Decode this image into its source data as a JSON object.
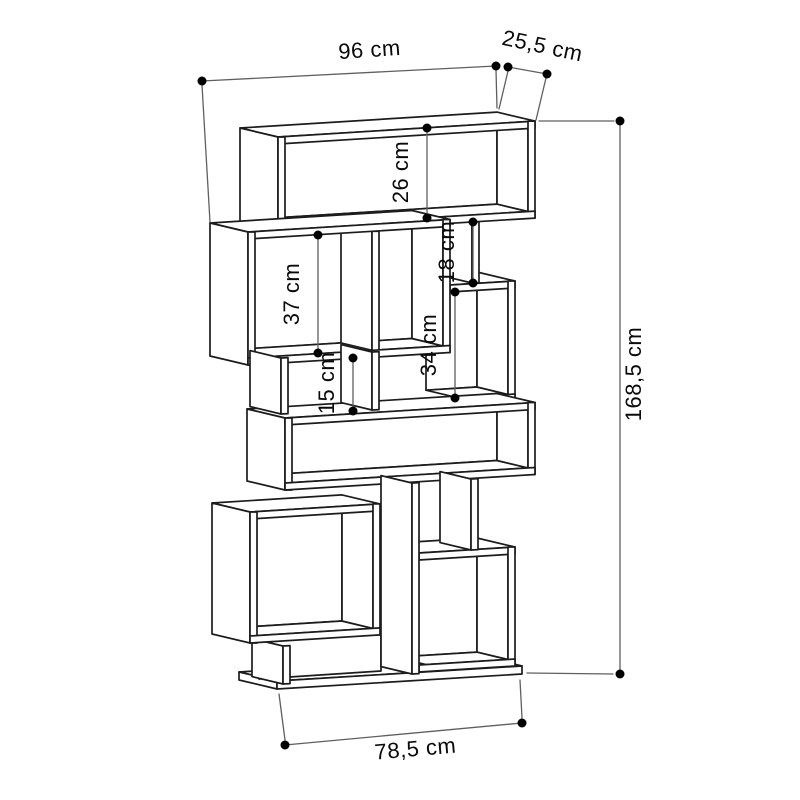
{
  "colors": {
    "background": "#ffffff",
    "furniture_outline": "#1c1c1c",
    "dimension_line": "#5f5f5f",
    "dimension_marker": "#000000",
    "label_text": "#0a0a0a"
  },
  "dimensions": {
    "width": {
      "label": "96 cm"
    },
    "depth": {
      "label": "25,5 cm"
    },
    "top_compartment_height": {
      "label": "26 cm"
    },
    "left_compartment_height": {
      "label": "37 cm"
    },
    "upper_right_compartment_height": {
      "label": "18 cm"
    },
    "middle_right_compartment_height": {
      "label": "34 cm"
    },
    "small_compartment_height": {
      "label": "15 cm"
    },
    "total_height": {
      "label": "168,5 cm"
    },
    "base_width": {
      "label": "78,5 cm"
    }
  }
}
